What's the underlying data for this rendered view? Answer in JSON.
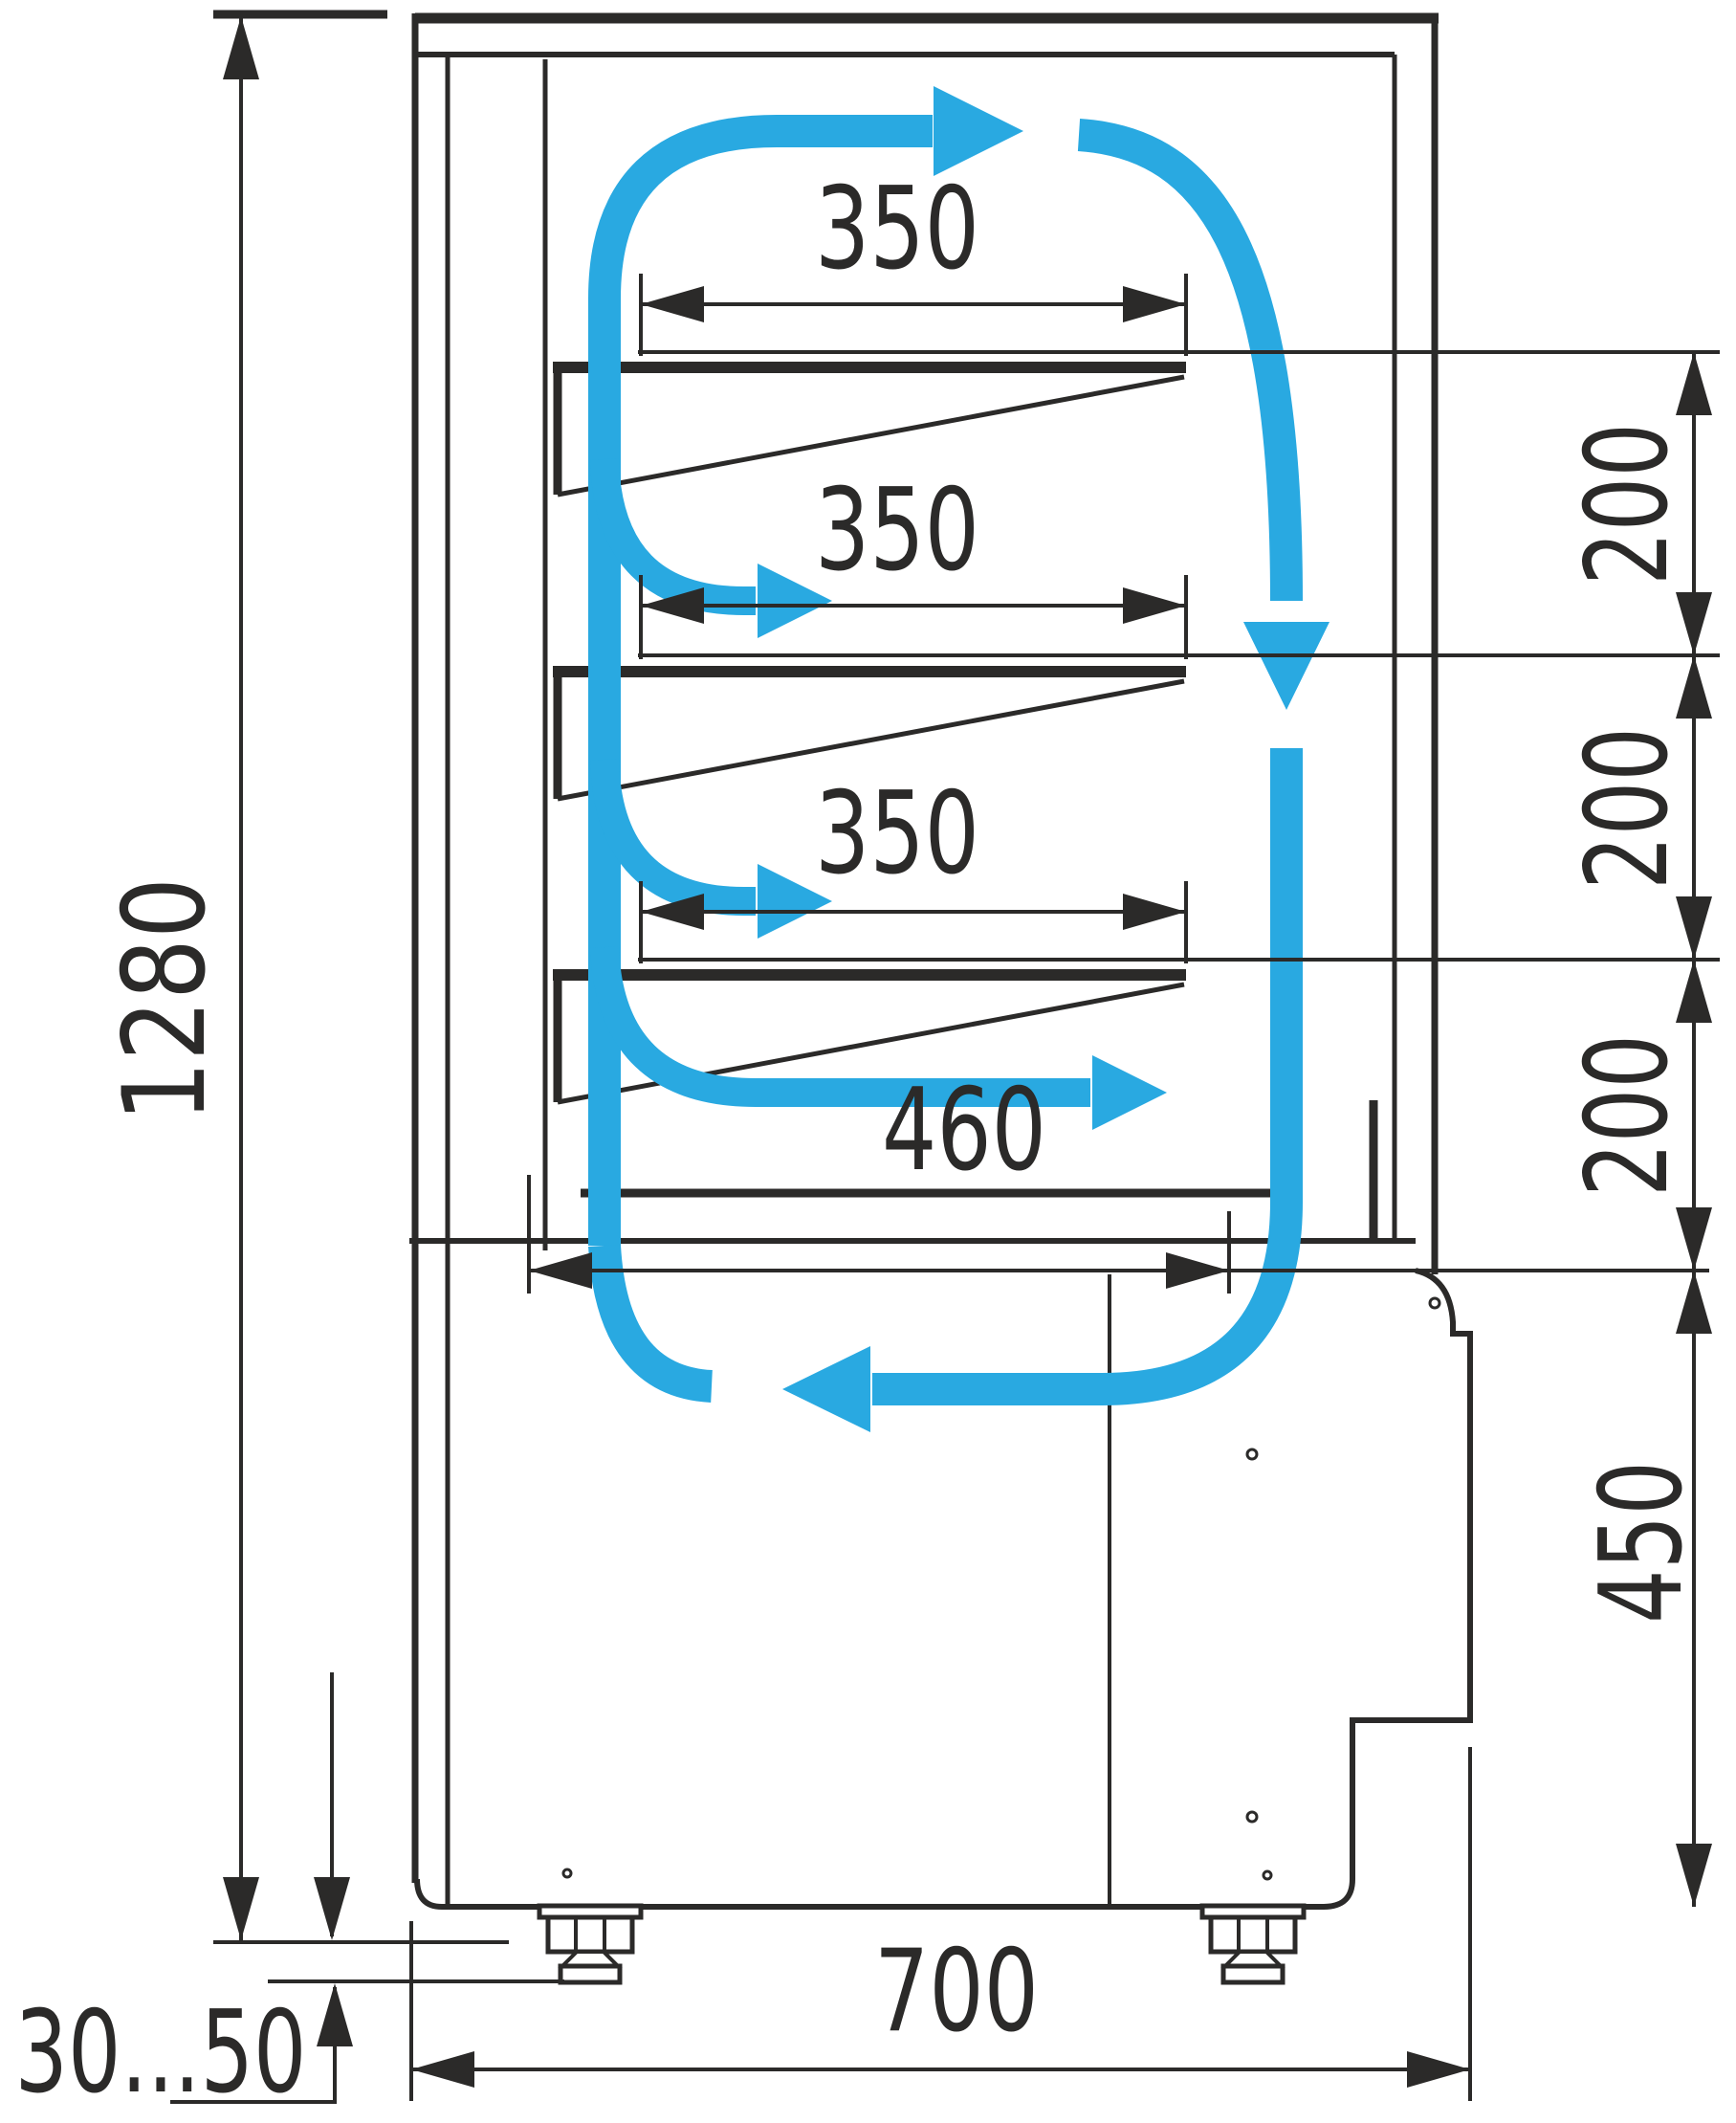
{
  "colors": {
    "ink": "#2b2a29",
    "accent": "#29a9e1",
    "bg": "#ffffff"
  },
  "drawing": {
    "labels": {
      "overall_height": "1280",
      "shelf1_width": "350",
      "shelf2_width": "350",
      "shelf3_width": "350",
      "deck_width": "460",
      "gap1": "200",
      "gap2": "200",
      "gap3": "200",
      "base_height": "450",
      "depth": "700",
      "feet_range": "30...50"
    }
  }
}
